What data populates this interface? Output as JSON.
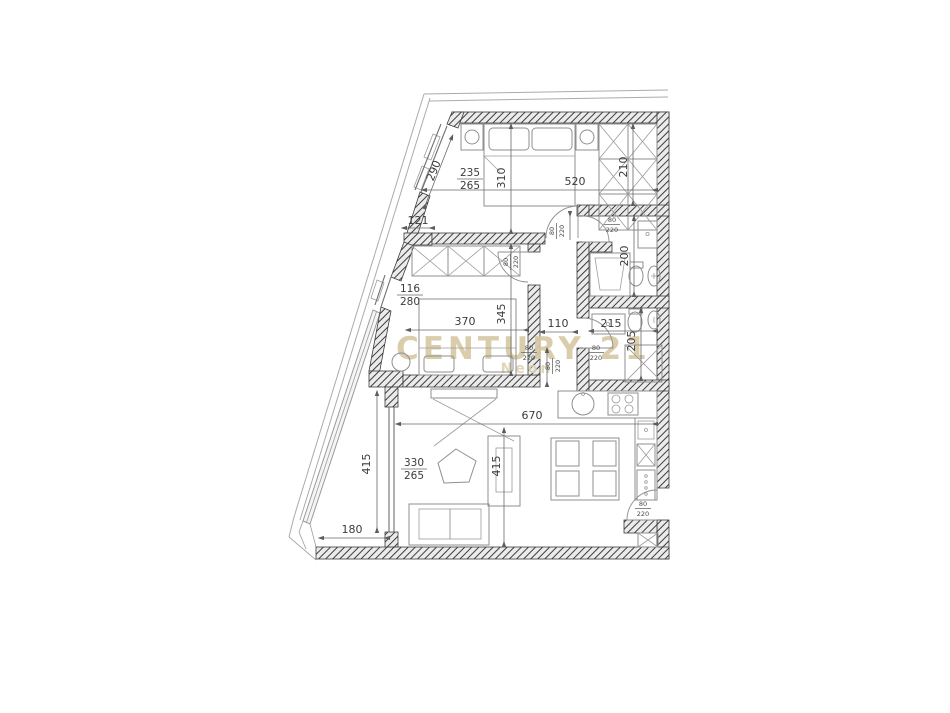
{
  "watermark": {
    "brand": "CENTURY 21",
    "sub": "Neon",
    "color": "#d6c9a4"
  },
  "plan": {
    "room_dims": {
      "bedroom1_diag_window": "290",
      "wall_121": "121",
      "bedroom1_depth": "310",
      "bedroom1_width": "520",
      "wardrobe_depth": "210",
      "bath1_length": "200",
      "bath2_width": "215",
      "bath2_depth": "205",
      "hall_width": "110",
      "room2_depth": "345",
      "room2_width": "370",
      "living_width": "670",
      "living_depth": "415",
      "balcony_length": "415",
      "balcony_width": "180"
    },
    "windows": {
      "w1_top": "235",
      "w1_bot": "265",
      "w2_top": "116",
      "w2_bot": "280",
      "w3_top": "330",
      "w3_bot": "265"
    },
    "doors": {
      "w": "80",
      "h": "220"
    }
  }
}
